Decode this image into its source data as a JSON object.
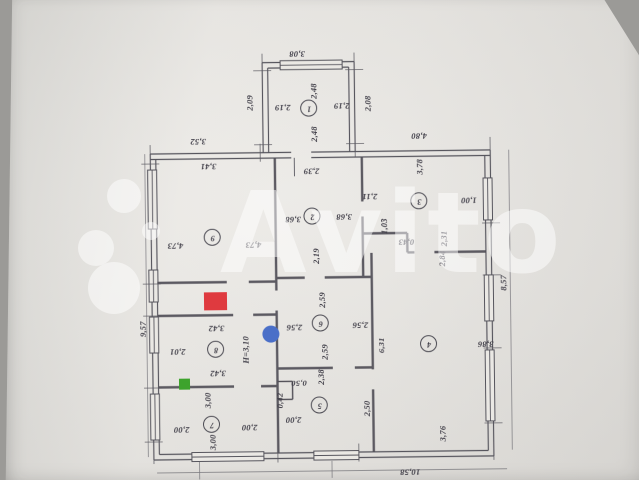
{
  "watermark": {
    "brand": "Avito",
    "letters": [
      "A",
      "v",
      "i",
      "t",
      "o"
    ],
    "color_rgba": "rgba(255,255,255,0.5)"
  },
  "plan": {
    "height_note": "H=3,10",
    "rooms": [
      {
        "n": "1",
        "x": 311,
        "y": 108
      },
      {
        "n": "2",
        "x": 313,
        "y": 216
      },
      {
        "n": "3",
        "x": 420,
        "y": 202
      },
      {
        "n": "4",
        "x": 428,
        "y": 345
      },
      {
        "n": "5",
        "x": 318,
        "y": 405
      },
      {
        "n": "6",
        "x": 320,
        "y": 323
      },
      {
        "n": "7",
        "x": 210,
        "y": 423
      },
      {
        "n": "8",
        "x": 215,
        "y": 348
      },
      {
        "n": "9",
        "x": 213,
        "y": 236
      }
    ],
    "dimension_labels": [
      {
        "text": "3,08",
        "x": 300,
        "y": 54,
        "o": "h"
      },
      {
        "text": "2,48",
        "x": 316,
        "y": 91,
        "o": "v"
      },
      {
        "text": "2,19",
        "x": 285,
        "y": 107,
        "o": "h"
      },
      {
        "text": "2,19",
        "x": 344,
        "y": 106,
        "o": "h"
      },
      {
        "text": "2,48",
        "x": 316,
        "y": 134,
        "o": "v"
      },
      {
        "text": "2,09",
        "x": 252,
        "y": 102,
        "o": "v"
      },
      {
        "text": "2,08",
        "x": 370,
        "y": 104,
        "o": "v"
      },
      {
        "text": "3,52",
        "x": 200,
        "y": 140,
        "o": "h"
      },
      {
        "text": "4,80",
        "x": 421,
        "y": 137,
        "o": "h"
      },
      {
        "text": "3,41",
        "x": 210,
        "y": 165,
        "o": "h"
      },
      {
        "text": "2,39",
        "x": 313,
        "y": 171,
        "o": "h"
      },
      {
        "text": "3,78",
        "x": 421,
        "y": 168,
        "o": "v"
      },
      {
        "text": "2,11",
        "x": 371,
        "y": 197,
        "o": "h"
      },
      {
        "text": "1,00",
        "x": 470,
        "y": 202,
        "o": "h"
      },
      {
        "text": "3,68",
        "x": 294,
        "y": 219,
        "o": "h"
      },
      {
        "text": "3,68",
        "x": 345,
        "y": 217,
        "o": "h"
      },
      {
        "text": "4,73",
        "x": 176,
        "y": 244,
        "o": "h"
      },
      {
        "text": "4,73",
        "x": 254,
        "y": 244,
        "o": "h"
      },
      {
        "text": "2,19",
        "x": 317,
        "y": 256,
        "o": "v"
      },
      {
        "text": "1,03",
        "x": 385,
        "y": 227,
        "o": "v"
      },
      {
        "text": "0,43",
        "x": 407,
        "y": 243,
        "o": "h"
      },
      {
        "text": "2,31",
        "x": 445,
        "y": 240,
        "o": "v"
      },
      {
        "text": "2,84",
        "x": 443,
        "y": 260,
        "o": "v"
      },
      {
        "text": "9,57",
        "x": 143,
        "y": 327,
        "o": "v"
      },
      {
        "text": "2,01",
        "x": 177,
        "y": 350,
        "o": "h"
      },
      {
        "text": "3,42",
        "x": 216,
        "y": 327,
        "o": "h"
      },
      {
        "text": "H=3,10",
        "x": 245,
        "y": 349,
        "o": "v"
      },
      {
        "text": "3,42",
        "x": 217,
        "y": 372,
        "o": "h"
      },
      {
        "text": "2,59",
        "x": 322,
        "y": 300,
        "o": "v"
      },
      {
        "text": "2,56",
        "x": 294,
        "y": 327,
        "o": "h"
      },
      {
        "text": "2,56",
        "x": 360,
        "y": 326,
        "o": "h"
      },
      {
        "text": "2,59",
        "x": 324,
        "y": 352,
        "o": "v"
      },
      {
        "text": "6,31",
        "x": 381,
        "y": 346,
        "o": "v"
      },
      {
        "text": "3,86",
        "x": 485,
        "y": 346,
        "o": "h"
      },
      {
        "text": "8,57",
        "x": 504,
        "y": 285,
        "o": "v"
      },
      {
        "text": "0,50",
        "x": 298,
        "y": 383,
        "o": "h"
      },
      {
        "text": "0,42",
        "x": 279,
        "y": 400,
        "o": "v"
      },
      {
        "text": "2,38",
        "x": 320,
        "y": 377,
        "o": "v"
      },
      {
        "text": "2,50",
        "x": 366,
        "y": 409,
        "o": "v"
      },
      {
        "text": "3,00",
        "x": 207,
        "y": 399,
        "o": "v"
      },
      {
        "text": "2,00",
        "x": 180,
        "y": 428,
        "o": "h"
      },
      {
        "text": "2,00",
        "x": 248,
        "y": 427,
        "o": "h"
      },
      {
        "text": "2,00",
        "x": 292,
        "y": 420,
        "o": "h"
      },
      {
        "text": "3,00",
        "x": 211,
        "y": 441,
        "o": "v"
      },
      {
        "text": "3,76",
        "x": 441,
        "y": 435,
        "o": "v"
      },
      {
        "text": "10,58",
        "x": 408,
        "y": 473,
        "o": "h"
      }
    ],
    "markers": {
      "red_square": {
        "x": 204,
        "y": 291,
        "w": 23,
        "h": 18,
        "color": "#df3a3f"
      },
      "blue_dot": {
        "x": 262,
        "y": 325,
        "w": 17,
        "h": 17,
        "color": "#4a6fc8"
      },
      "green_square": {
        "x": 178,
        "y": 377,
        "w": 11,
        "h": 11,
        "color": "#3da32c"
      }
    }
  }
}
